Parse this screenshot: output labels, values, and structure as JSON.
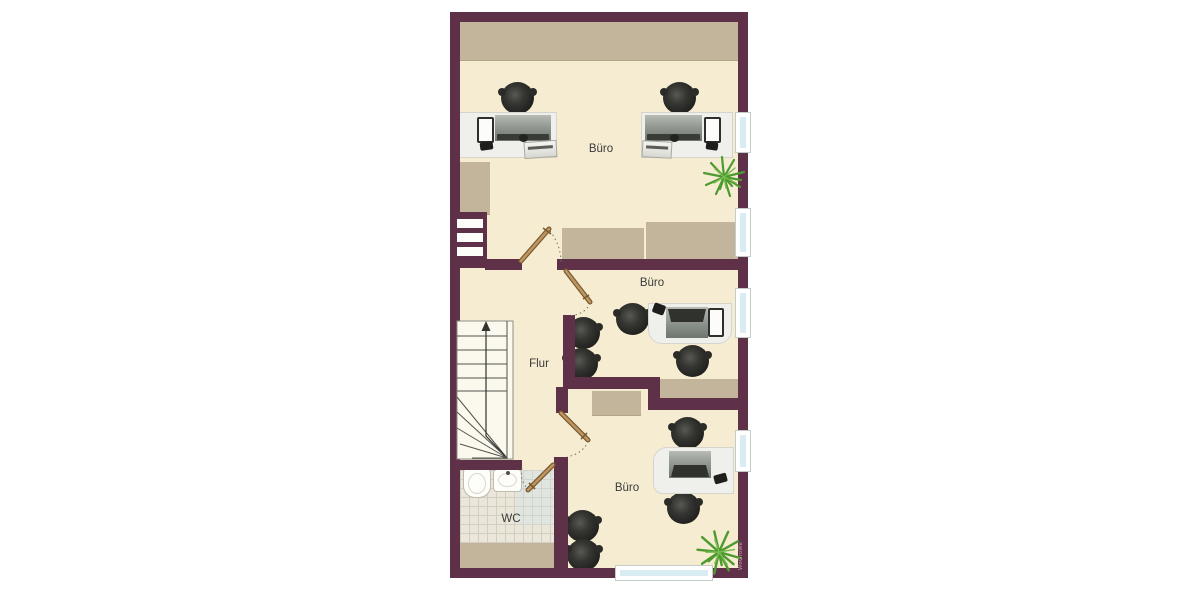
{
  "floorplan": {
    "rooms": {
      "office_top": {
        "label": "Büro"
      },
      "office_middle": {
        "label": "Büro"
      },
      "office_bottom": {
        "label": "Büro"
      },
      "hallway": {
        "label": "Flur"
      },
      "wc": {
        "label": "WC"
      }
    },
    "watermark": "WoGroWe",
    "icons": [
      "stairs",
      "door-swing",
      "office-chair",
      "desk-workstation",
      "monitor",
      "printer",
      "phone",
      "plant",
      "toilet",
      "sink",
      "window"
    ],
    "colors": {
      "wall": "#5e3148",
      "floor": "#f6ecd1",
      "furniture_tan": "#c3b59b",
      "window_glass": "#d8ecf1",
      "tile": "#eae6da",
      "door_leaf": "#a9834f",
      "plant": "#4d9a2e",
      "chair": "#242422",
      "label_text": "#3a3a3a"
    }
  }
}
